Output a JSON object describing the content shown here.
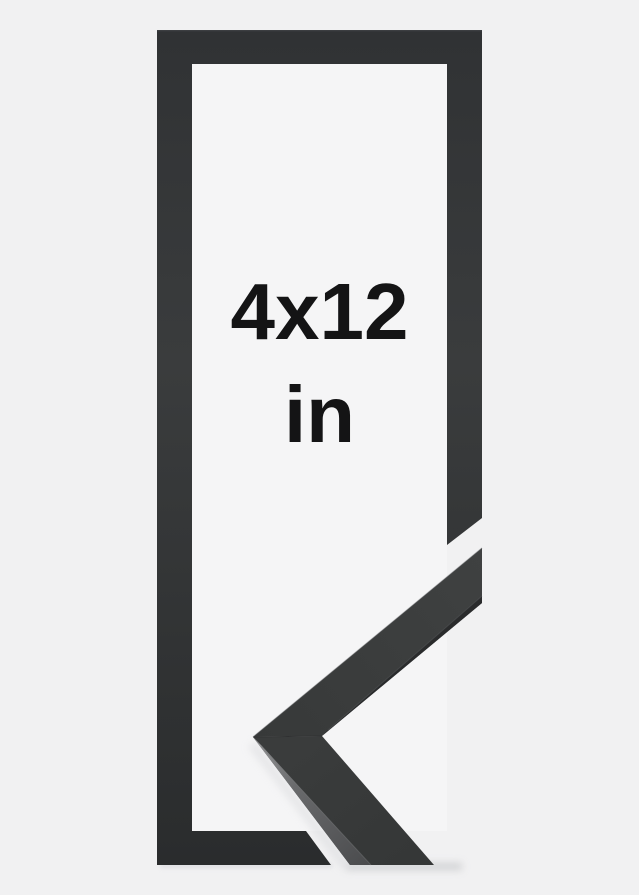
{
  "product_photo": {
    "size_label": {
      "dimensions": "4x12",
      "unit": "in"
    },
    "colors": {
      "background": "#f1f1f2",
      "opening_white": "#f5f5f6",
      "frame_top": "#303234",
      "frame_mid": "#3a3c3d",
      "frame_bottom": "#2a2c2d",
      "sample_face_dark": "#373939",
      "sample_face_light": "#3f4141",
      "sample_face": "#3a3c3c",
      "sample_face_shaded": "#353737",
      "sample_edge_shadow": "#28292a",
      "edge_strip_bright": "#97989a",
      "edge_strip_mid": "#6a6b6d",
      "edge_strip_dark": "#4a4b4d",
      "text": "#141415",
      "soft_shadow": "#c9cacd"
    }
  }
}
